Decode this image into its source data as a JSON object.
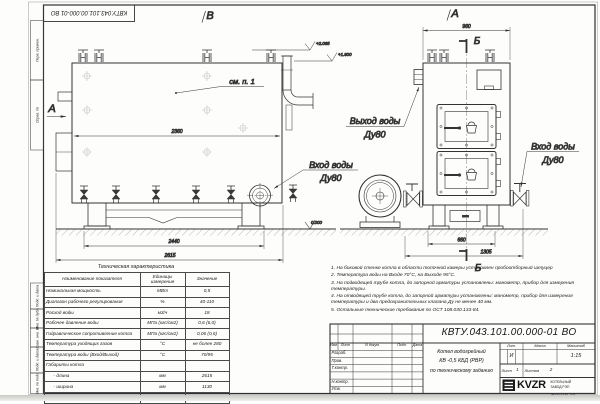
{
  "sheet": {
    "doc_number": "КВТУ.043.101.00.000-01 ВО",
    "format_label": "Формат  А3",
    "margin_labels": [
      "Перв. примен.",
      "Справ. №",
      "Подп. и дата",
      "Инв. № дубл.",
      "Взам. инв. №",
      "Подп. и дата",
      "Инв. № подл."
    ]
  },
  "side_view": {
    "view_label": "В",
    "arrow_label": "А",
    "see_note": "см. п. 1",
    "dim_width_top": "2360",
    "dim_width_feet": "2440",
    "dim_width_total": "2615",
    "elev_top": "+2.065",
    "elev_pipe": "+1.900",
    "elev_zero": "0.000",
    "inlet_line1": "Вход воды",
    "inlet_line2": "Ду80"
  },
  "front_view": {
    "view_label": "А",
    "section_top": "Б",
    "section_bottom": "Б",
    "dim_width_top": "960",
    "dim_feet": "660",
    "dim_total": "1305",
    "outlet_line1": "Выход воды",
    "outlet_line2": "Ду80",
    "inlet_line1": "Вход воды",
    "inlet_line2": "Ду80"
  },
  "spec_table": {
    "title": "Техническая характеристика",
    "col_name": "Наименование показателя",
    "col_units": "Единицы измерения",
    "col_value": "Значение",
    "rows": [
      {
        "name": "Номинальная мощность",
        "units": "МВт",
        "value": "0,5"
      },
      {
        "name": "Диапазон рабочего регулирования",
        "units": "%",
        "value": "40-110"
      },
      {
        "name": "Расход воды",
        "units": "м3/ч",
        "value": "18"
      },
      {
        "name": "Рабочее давление воды",
        "units": "МПа (кгс/см2)",
        "value": "0,6 (6,0)"
      },
      {
        "name": "Гидравлическое сопротивление котла",
        "units": "МПа (кгс/см2)",
        "value": "0,06 (0,6)"
      },
      {
        "name": "Температура уходящих газов",
        "units": "°С",
        "value": "не более 280"
      },
      {
        "name": "Температура воды (Вход/Выход)",
        "units": "°С",
        "value": "70/95"
      },
      {
        "name": "Габариты котла",
        "units": "",
        "value": ""
      },
      {
        "name": "- длина",
        "units": "мм",
        "value": "2615"
      },
      {
        "name": "- ширина",
        "units": "мм",
        "value": "1130"
      },
      {
        "name": "- высота",
        "units": "мм",
        "value": "1950"
      }
    ]
  },
  "notes": {
    "n1": "1.  На боковой стенке котла в области топочной камеры установлен пробоотборный штуцер",
    "n2": "2.  Температура воды на Входе 70°С, на Выходе 95°С.",
    "n3": "3.  На подводящей трубе котла, до запорной арматуры установлены: манометр, прибор для измерения температуры.",
    "n4": "4.  На отводящей трубе котла, до запорной арматуры установлены: манометр, прибор для измерения температуры и два предохранительных клапана Ду не менее 40 мм.",
    "n5": "5.  Остальные технические требования по ОСТ 108.030.133-84."
  },
  "title_block": {
    "doc_number": "КВТУ.043.101.00.000-01  ВО",
    "col_izm": "Изм.",
    "col_list": "Лист",
    "col_doc": "N докум.",
    "col_sign": "Подп.",
    "col_date": "Дата",
    "row_developed": "Разраб.",
    "row_checked": "Пров.",
    "row_tcontrol": "Т.контр.",
    "row_ncontrol": "Н.контр.",
    "row_approved": "Утв.",
    "product_line1": "Котел водогрейный",
    "product_line2": "КВ -0,5  КБД  (РВР)",
    "product_line3": "по техническому заданию",
    "lit_label": "Лит.",
    "lit_value": "И",
    "mass_label": "Масса",
    "scale_label": "Масштаб",
    "scale_value": "1:15",
    "sheet_label": "Лист",
    "sheet_number": "1",
    "sheets_label": "Листов",
    "sheets_total": "2",
    "logo_text": "KVZR",
    "logo_caption1": "КОТЕЛЬНЫЙ",
    "logo_caption2": "ЗАВОД РЭП"
  }
}
